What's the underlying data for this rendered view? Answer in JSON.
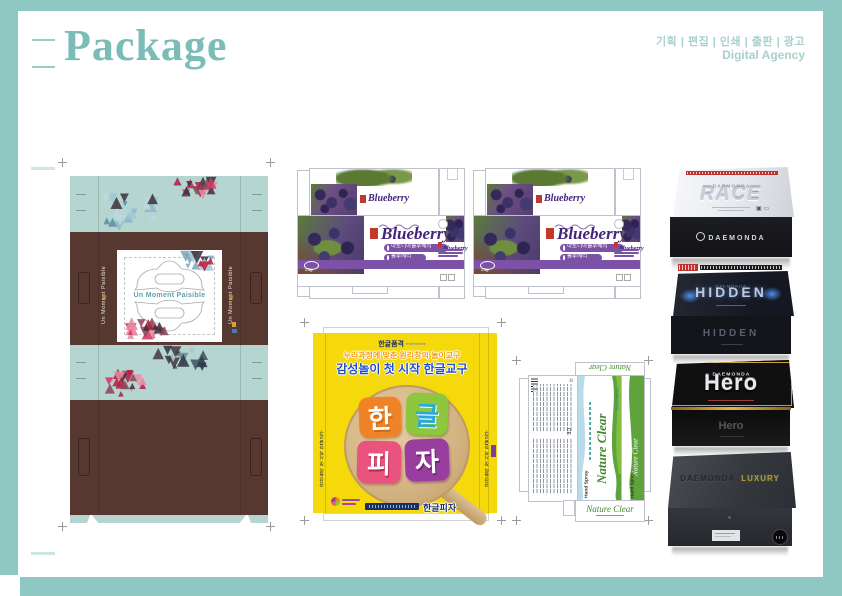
{
  "colors": {
    "frame": "#8fc7c2",
    "title": "#7cbcb8",
    "header_text": "#a9d0cd",
    "mint": "#b5d5d0",
    "brown": "#573830",
    "blueberry_purple": "#7b52a5",
    "blueberry_title": "#43237e",
    "pizza_yellow": "#f6d90a",
    "pizza_blue": "#1f4fd0",
    "nature_green": "#3f8a2e",
    "triangles_pink": [
      "#d63864",
      "#b02045",
      "#3f3440",
      "#e88aa0",
      "#8a4a5a"
    ],
    "triangles_teal": [
      "#8fb7c8",
      "#bcd8de",
      "#5b8fa3",
      "#3f3440",
      "#9ccad4"
    ],
    "triangles_dark": [
      "#3f5560",
      "#6d8f9c",
      "#a8c8d2",
      "#4a3a45",
      "#2e3844"
    ],
    "triangles_mix": [
      "#d63864",
      "#a8ccd8",
      "#3f3440",
      "#7fa8bc",
      "#c21f45"
    ]
  },
  "header": {
    "title": "Package",
    "services": "기획 | 편집 | 인쇄 | 출판 | 광고",
    "agency": "Digital Agency"
  },
  "moment": {
    "brand": "Un Moment Paisible"
  },
  "blueberry": {
    "title": "Blueberry",
    "item1": "아로니아블루베리",
    "item2": "블루베리",
    "weight": "25g"
  },
  "pizza": {
    "brand": "한글품격",
    "line1": "누리과정에 맞춘 원리창의 놀이교구",
    "line2": "감성놀이 첫 시작 한글교구",
    "char1": "한",
    "char2": "글",
    "char3": "피",
    "char4": "자",
    "product": "한글피자",
    "side_text": "감성놀이 첫 시작 한글교구"
  },
  "nature": {
    "title": "Nature Clear",
    "side_label": "Hand Spray",
    "logo": "BLOOMING",
    "ce": "CE"
  },
  "boxes": [
    {
      "brand": "DAEMONDA",
      "name": "RACE",
      "front": "DAEMONDA"
    },
    {
      "brand": "DAEMONDA",
      "name": "HIDDEN",
      "front": "HIDDEN"
    },
    {
      "brand": "DAEMONDA",
      "name": "Hero",
      "front": "Hero"
    },
    {
      "brand": "DAEMONDA",
      "name": "LUXURY",
      "front": ""
    }
  ]
}
